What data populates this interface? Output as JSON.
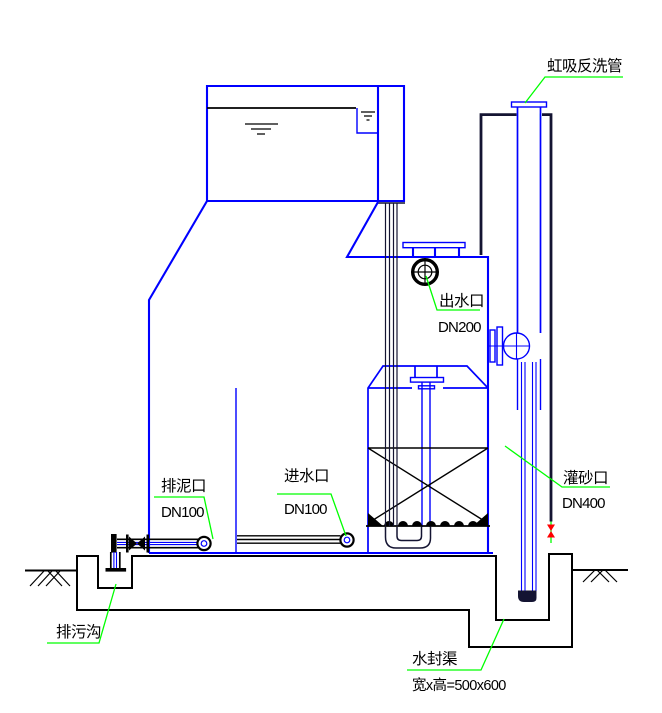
{
  "drawing": {
    "type": "engineering-section-valveless-gravity-filter",
    "labels": {
      "siphon_backwash_pipe": "虹吸反洗管",
      "outlet_name": "出水口",
      "outlet_size": "DN200",
      "mud_port_name": "排泥口",
      "mud_port_size": "DN100",
      "inlet_name": "进水口",
      "inlet_size": "DN100",
      "sand_port_name": "灌砂口",
      "sand_port_size": "DN400",
      "sewage_ditch": "排污沟",
      "water_seal_name": "水封渠",
      "water_seal_dim": "宽x高=500x600"
    },
    "colors": {
      "pipe_blue": "#0000FF",
      "leader_green": "#00FF00",
      "line_black": "#000000",
      "thick_pipe_dark": "#141432",
      "valve_red": "#FF0000",
      "tick_cyan": "#00FFFF",
      "concrete_gray": "#8f8f8f"
    }
  }
}
